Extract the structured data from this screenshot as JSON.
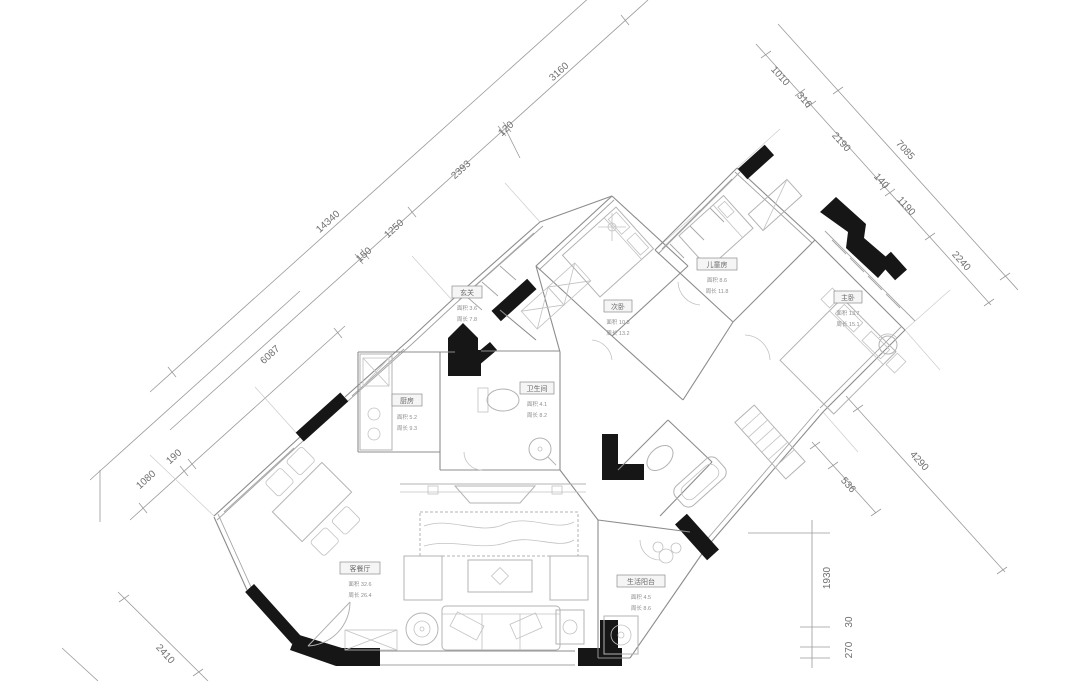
{
  "drawing": {
    "type": "residential floor plan (rotated CAD drawing)",
    "ink_color": "#161616",
    "line_color": "#8c8c8c"
  },
  "dimensions": {
    "top_left": {
      "overall": "14340",
      "chain": [
        "150",
        "1250",
        "2393",
        "120",
        "3160"
      ]
    },
    "top_right": {
      "overall": "7085",
      "chain": [
        "1010",
        "316",
        "2190",
        "140",
        "1190",
        "2240"
      ]
    },
    "left": {
      "chain": [
        "6087",
        "1080",
        "190"
      ],
      "bottom": "2410"
    },
    "bottom_right": {
      "diagonal": [
        "536",
        "4290"
      ],
      "vertical": [
        "1930",
        "270",
        "30"
      ]
    }
  },
  "rooms": [
    {
      "name": "客餐厅",
      "area_line": "面积 32.6",
      "perimeter_line": "周长 26.4"
    },
    {
      "name": "厨房",
      "area_line": "面积 5.2",
      "perimeter_line": "周长 9.3"
    },
    {
      "name": "玄关",
      "area_line": "面积 3.6",
      "perimeter_line": "周长 7.8"
    },
    {
      "name": "卫生间",
      "area_line": "面积 4.1",
      "perimeter_line": "周长 8.2"
    },
    {
      "name": "次卧",
      "area_line": "面积 10.8",
      "perimeter_line": "周长 13.2"
    },
    {
      "name": "儿童房",
      "area_line": "面积 8.6",
      "perimeter_line": "周长 11.8"
    },
    {
      "name": "主卧",
      "area_line": "面积 13.7",
      "perimeter_line": "周长 15.1"
    },
    {
      "name": "生活阳台",
      "area_line": "面积 4.5",
      "perimeter_line": "周长 8.6"
    }
  ]
}
